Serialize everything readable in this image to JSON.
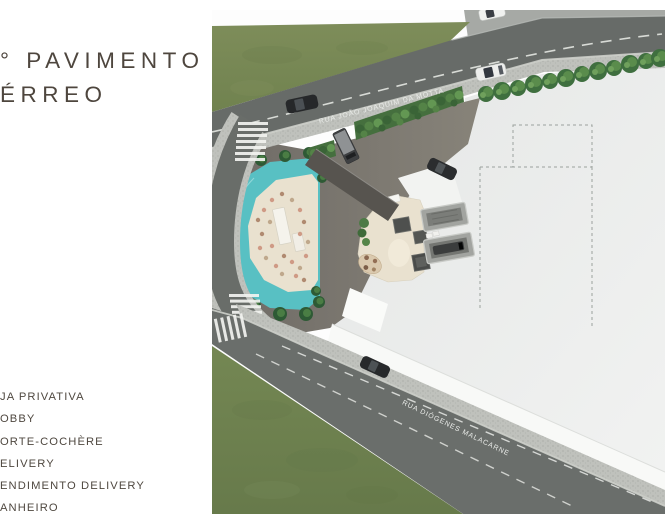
{
  "title": {
    "line1": "° PAVIMENTO",
    "line2": "ÉRREO"
  },
  "legend": {
    "items": [
      "JA PRIVATIVA",
      "OBBY",
      "ORTE-COCHÈRE",
      "ELIVERY",
      "ENDIMENTO DELIVERY",
      "ANHEIRO"
    ]
  },
  "plan": {
    "street_top": "RUA JOÃO JOAQUIM DA MOTTA",
    "street_bottom": "RUA DIÓGENES MALACARNE",
    "colors": {
      "heading_text": "#4e463e",
      "grass": "#74864f",
      "asphalt": "#676b68",
      "sidewalk": "#bfc1bc",
      "building_lot": "#eceeed",
      "plaza": "#7b7772",
      "pool": "#58c0c3",
      "terrace": "#e9e1cf",
      "hedge": "#456f3e",
      "street_label_text": "#e9ebe8"
    }
  }
}
